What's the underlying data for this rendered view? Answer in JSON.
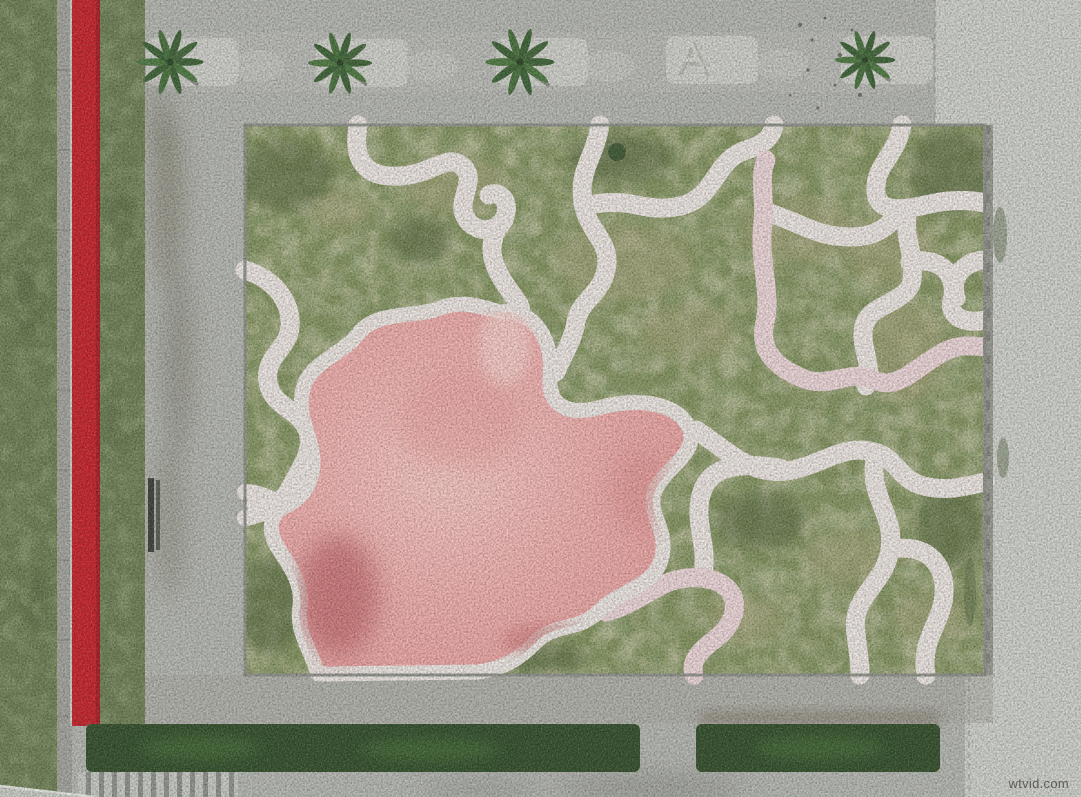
{
  "image": {
    "kind": "aerial-drone-photograph",
    "description": "Top-down drone view of a landscaped park: a rectangular lawn crossed by organic maze-like white paths with a large pink painted pool shape, bordered by gray concrete walkways, a bright red running stripe on the left, four palm trees along the top walkway, an a-frame sign, a bench, trimmed hedges and stairs at the bottom.",
    "width_px": 1081,
    "height_px": 797
  },
  "watermark": {
    "text": "wtvid.com",
    "color": "#4a4a4a"
  },
  "palette": {
    "concrete": "#b5b7b1",
    "concrete_light": "#cfd1cb",
    "concrete_band": "#a9aba3",
    "path_white": "#ece6e2",
    "path_pink_tint": "#ecd6d8",
    "lawn_green": "#83935f",
    "lawn_strip": "#6e7f55",
    "lawn_dark": "#5a6b42",
    "lawn_dry": "#a9a67d",
    "pink_light": "#f6c9c5",
    "pink_mid": "#eca9a7",
    "pink_dark": "#c26a6e",
    "red_stripe": "#c5242b",
    "hedge_green": "#34502c",
    "palm_green": "#3e6337",
    "stone_gray": "#a3a49e"
  },
  "features": {
    "palm_trees": {
      "count": 4,
      "location": "top-walkway"
    },
    "a_frame_sign": {
      "count": 1,
      "location": "top-walkway"
    },
    "bench": {
      "count": 1,
      "location": "left-walkway"
    },
    "hedges": {
      "count": 2,
      "location": "bottom"
    },
    "stairs": {
      "count": 1,
      "location": "bottom-left"
    },
    "red_stripe": {
      "count": 1,
      "location": "left-edge"
    },
    "maze_lawn": {
      "paths": "winding white painted paths",
      "pool": "organic pink painted area"
    }
  }
}
